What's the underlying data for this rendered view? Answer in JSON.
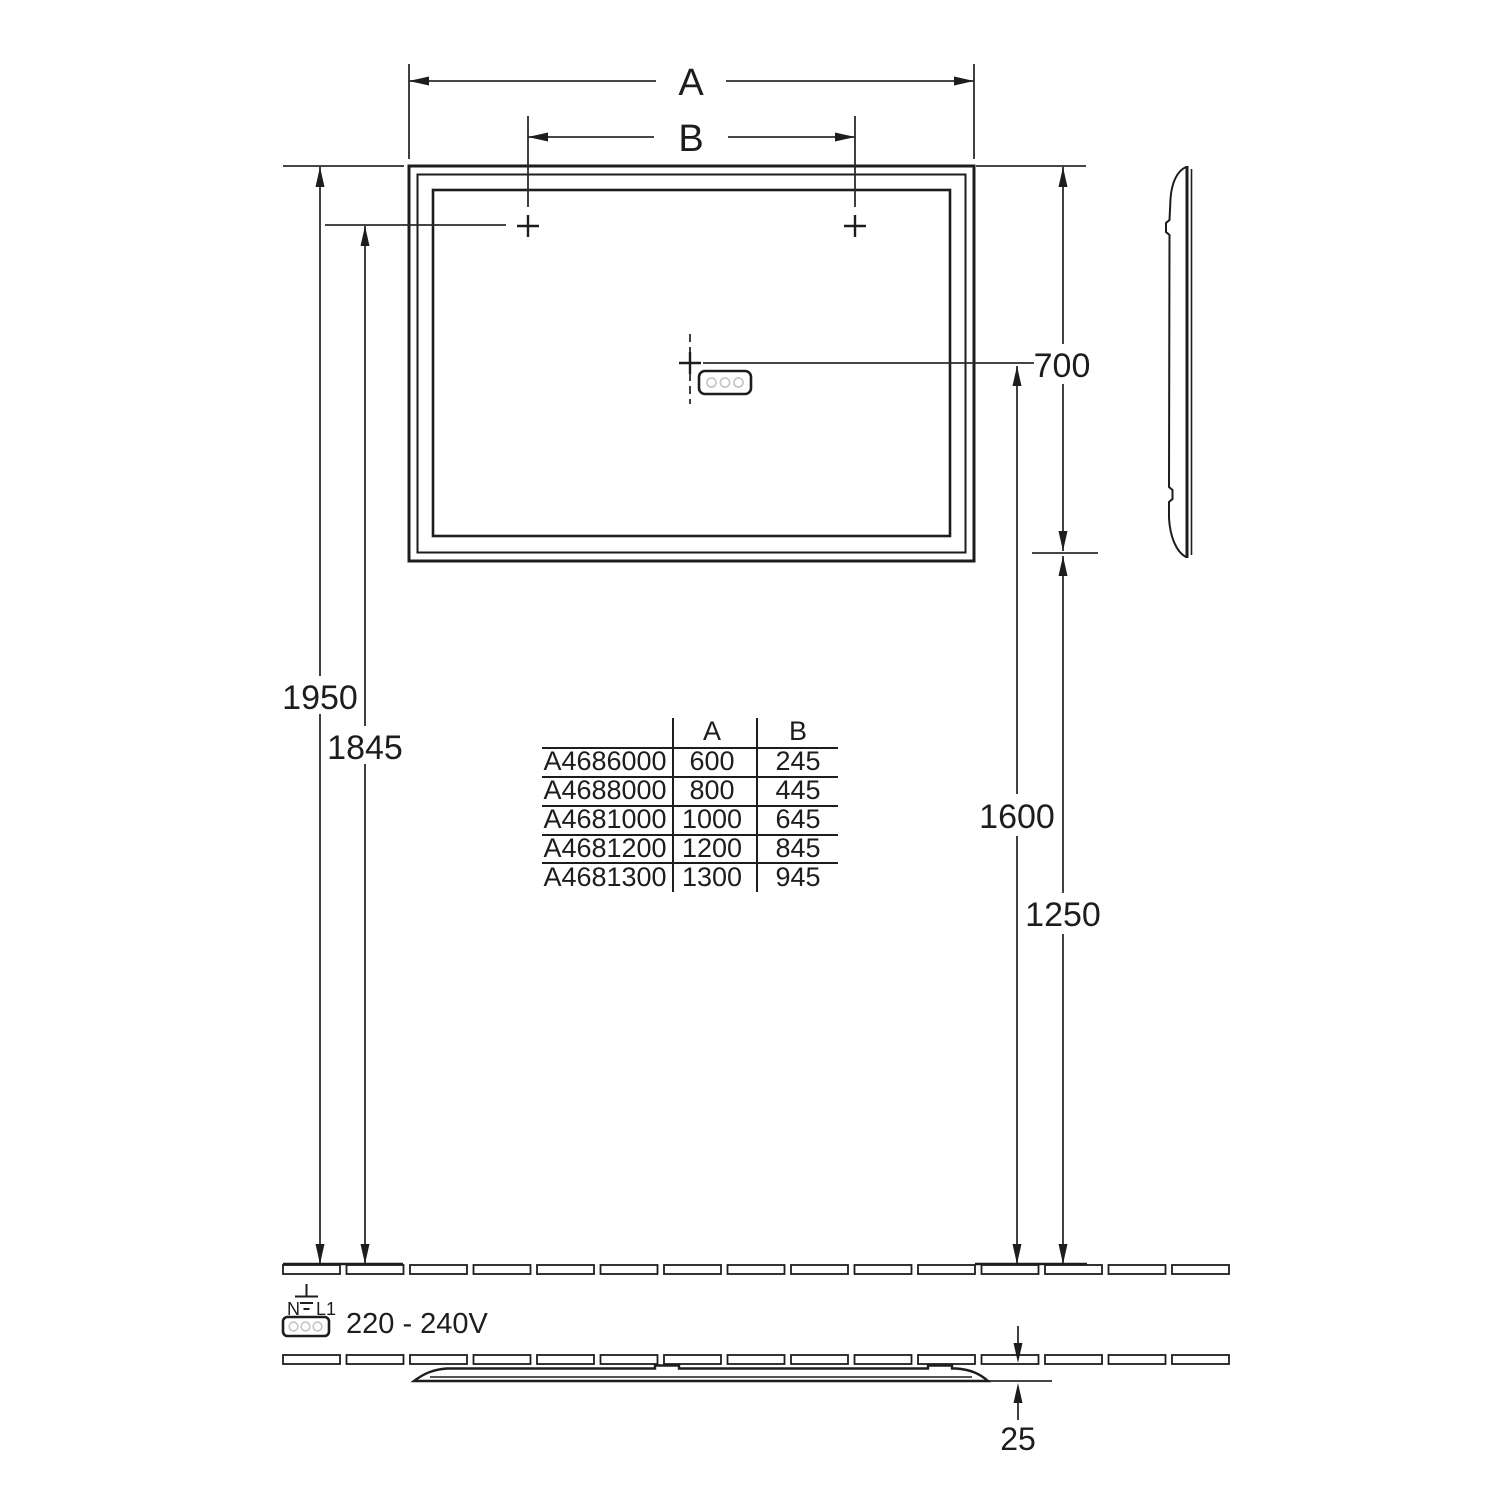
{
  "drawing_type": "mirror installation dimensional drawing",
  "dimensions": {
    "width_label": "A",
    "mount_spacing_label": "B",
    "mirror_height": "700",
    "total_height": "1950",
    "mount_height": "1845",
    "control_height": "1600",
    "bottom_height": "1250",
    "depth": "25"
  },
  "power": {
    "terminal_n": "N",
    "terminal_l1": "L1",
    "voltage": "220 - 240V"
  },
  "size_table": {
    "col_article": "",
    "col_a": "A",
    "col_b": "B",
    "rows": [
      {
        "article": "A4686000",
        "a": "600",
        "b": "245"
      },
      {
        "article": "A4688000",
        "a": "800",
        "b": "445"
      },
      {
        "article": "A4681000",
        "a": "1000",
        "b": "645"
      },
      {
        "article": "A4681200",
        "a": "1200",
        "b": "845"
      },
      {
        "article": "A4681300",
        "a": "1300",
        "b": "945"
      }
    ]
  },
  "colors": {
    "line": "#1d1d1d",
    "dimension_line": "#2b2b2b",
    "connector_circle": "#c4c4c4",
    "background": "#ffffff"
  }
}
